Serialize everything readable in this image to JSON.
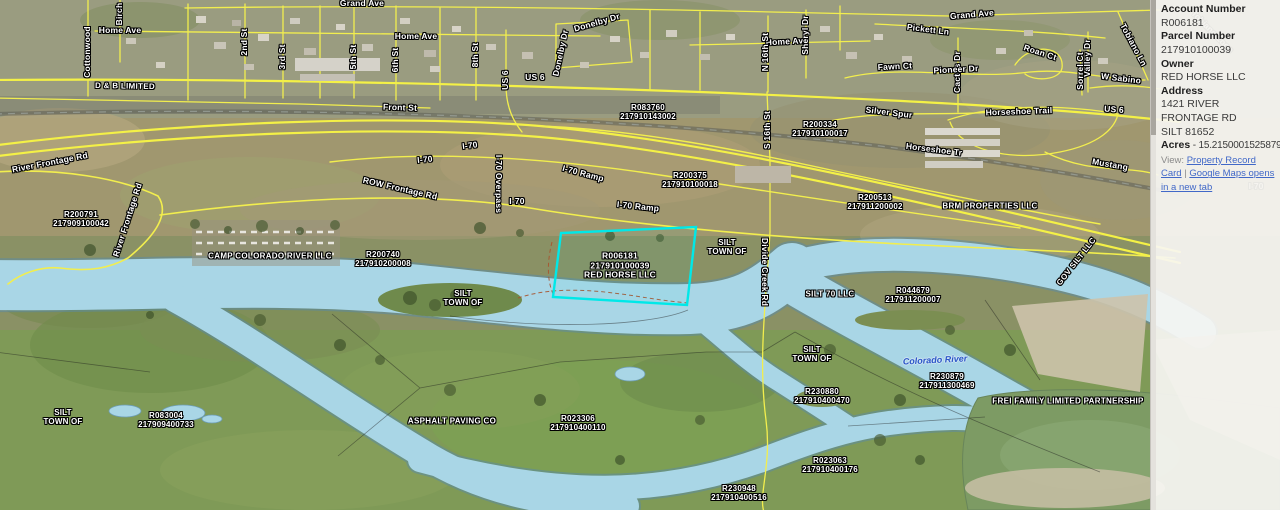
{
  "panel": {
    "fields": [
      {
        "label": "Account Number",
        "value": "R006181"
      },
      {
        "label": "Parcel Number",
        "value": "217910100039"
      },
      {
        "label": "Owner",
        "value": "RED HORSE LLC"
      },
      {
        "label": "Address",
        "value": "1421 RIVER FRONTAGE RD\nSILT 81652"
      }
    ],
    "acres": {
      "label": "Acres",
      "value": " - 15.2150001525879"
    },
    "view": {
      "label": "View: ",
      "separator": " | ",
      "links": [
        "Property Record Card",
        "Google Maps opens in a new tab"
      ]
    }
  },
  "map": {
    "selected_parcel": {
      "id": "R006181",
      "outline_color": "#00e8e8"
    },
    "colors": {
      "road": "#f2ee4e",
      "water": "#a9d6e6",
      "selection": "#00e8e8",
      "river_label": "#2b55c8"
    },
    "labels": [
      {
        "t": "Grand Ave",
        "x": 362,
        "y": 4,
        "r": 0,
        "k": "st"
      },
      {
        "t": "Grand Ave",
        "x": 972,
        "y": 15,
        "r": -5,
        "k": "st"
      },
      {
        "t": "Home Ave",
        "x": 120,
        "y": 31,
        "r": 0,
        "k": "st"
      },
      {
        "t": "Cottonwood",
        "x": 88,
        "y": 52,
        "r": -90,
        "k": "st"
      },
      {
        "t": "Birch",
        "x": 120,
        "y": 14,
        "r": -90,
        "k": "st"
      },
      {
        "t": "2nd St",
        "x": 245,
        "y": 42,
        "r": -90,
        "k": "st"
      },
      {
        "t": "3rd St",
        "x": 283,
        "y": 57,
        "r": -90,
        "k": "st"
      },
      {
        "t": "5th St",
        "x": 354,
        "y": 57,
        "r": -90,
        "k": "st"
      },
      {
        "t": "6th St",
        "x": 396,
        "y": 60,
        "r": -90,
        "k": "st"
      },
      {
        "t": "Home Ave",
        "x": 416,
        "y": 37,
        "r": 0,
        "k": "st"
      },
      {
        "t": "8th St",
        "x": 476,
        "y": 55,
        "r": -90,
        "k": "st"
      },
      {
        "t": "US 6",
        "x": 506,
        "y": 80,
        "r": -90,
        "k": "st"
      },
      {
        "t": "US 6",
        "x": 535,
        "y": 78,
        "r": 0,
        "k": "st"
      },
      {
        "t": "Donelby Dr",
        "x": 597,
        "y": 23,
        "r": -16,
        "k": "st"
      },
      {
        "t": "Donelby Dr",
        "x": 561,
        "y": 53,
        "r": -78,
        "k": "st"
      },
      {
        "t": "Home Ave",
        "x": 787,
        "y": 42,
        "r": -3,
        "k": "st"
      },
      {
        "t": "N 16th St",
        "x": 766,
        "y": 52,
        "r": -90,
        "k": "st"
      },
      {
        "t": "S 16th St",
        "x": 768,
        "y": 130,
        "r": -90,
        "k": "st"
      },
      {
        "t": "Sheryl Dr",
        "x": 806,
        "y": 35,
        "r": -90,
        "k": "st"
      },
      {
        "t": "Pickett Ln",
        "x": 928,
        "y": 30,
        "r": 7,
        "k": "st"
      },
      {
        "t": "Cactus Dr",
        "x": 958,
        "y": 72,
        "r": -90,
        "k": "st"
      },
      {
        "t": "Valley Dr",
        "x": 1088,
        "y": 58,
        "r": -90,
        "k": "st"
      },
      {
        "t": "Fawn Ct",
        "x": 895,
        "y": 67,
        "r": -3,
        "k": "st"
      },
      {
        "t": "Pioneer Dr",
        "x": 956,
        "y": 70,
        "r": -3,
        "k": "st"
      },
      {
        "t": "Roan Ct",
        "x": 1040,
        "y": 53,
        "r": 18,
        "k": "st"
      },
      {
        "t": "Sorrel Ct",
        "x": 1081,
        "y": 71,
        "r": -90,
        "k": "st"
      },
      {
        "t": "Tobiano Ln",
        "x": 1133,
        "y": 45,
        "r": 62,
        "k": "st"
      },
      {
        "t": "W Sabino",
        "x": 1121,
        "y": 79,
        "r": 7,
        "k": "st"
      },
      {
        "t": "D & B LIMITED",
        "x": 125,
        "y": 87,
        "r": 1,
        "k": "own"
      },
      {
        "t": "Front St",
        "x": 400,
        "y": 108,
        "r": 2,
        "k": "st"
      },
      {
        "t": "Silver Spur",
        "x": 889,
        "y": 113,
        "r": 7,
        "k": "st"
      },
      {
        "t": "Horseshoe Trail",
        "x": 1019,
        "y": 112,
        "r": -2,
        "k": "st"
      },
      {
        "t": "US 6",
        "x": 1114,
        "y": 110,
        "r": 4,
        "k": "st"
      },
      {
        "t": "Horseshoe Tr",
        "x": 934,
        "y": 150,
        "r": 7,
        "k": "st"
      },
      {
        "t": "Mustang",
        "x": 1110,
        "y": 165,
        "r": 10,
        "k": "st"
      },
      {
        "t": "River Frontage Rd",
        "x": 50,
        "y": 163,
        "r": -11,
        "k": "st"
      },
      {
        "t": "River Frontage Rd",
        "x": 128,
        "y": 220,
        "r": -72,
        "k": "st"
      },
      {
        "t": "I-70",
        "x": 425,
        "y": 160,
        "r": -6,
        "k": "st"
      },
      {
        "t": "I-70",
        "x": 470,
        "y": 146,
        "r": -7,
        "k": "st"
      },
      {
        "t": "I-70 Overpass",
        "x": 498,
        "y": 184,
        "r": 90,
        "k": "st"
      },
      {
        "t": "I-70",
        "x": 517,
        "y": 202,
        "r": 0,
        "k": "st"
      },
      {
        "t": "I-70 Ramp",
        "x": 583,
        "y": 174,
        "r": 15,
        "k": "st"
      },
      {
        "t": "I-70 Ramp",
        "x": 638,
        "y": 207,
        "r": 6,
        "k": "st"
      },
      {
        "t": "ROW Frontage Rd",
        "x": 400,
        "y": 189,
        "r": 13,
        "k": "st"
      },
      {
        "t": "Divide Creek Rd",
        "x": 764,
        "y": 272,
        "r": 90,
        "k": "st"
      },
      {
        "t": [
          "R083760",
          "217910143002"
        ],
        "x": 648,
        "y": 113,
        "r": 0,
        "k": "pid"
      },
      {
        "t": [
          "R200334",
          "217910100017"
        ],
        "x": 820,
        "y": 130,
        "r": 0,
        "k": "pid"
      },
      {
        "t": [
          "R200375",
          "217910100018"
        ],
        "x": 690,
        "y": 181,
        "r": 0,
        "k": "pid"
      },
      {
        "t": [
          "R200513",
          "217911200002"
        ],
        "x": 875,
        "y": 203,
        "r": 0,
        "k": "pid"
      },
      {
        "t": [
          "R200791",
          "217909100042"
        ],
        "x": 81,
        "y": 220,
        "r": 0,
        "k": "pid"
      },
      {
        "t": [
          "R200740",
          "217910200008"
        ],
        "x": 383,
        "y": 260,
        "r": 0,
        "k": "pid"
      },
      {
        "t": [
          "R006181",
          "217910100039",
          "RED HORSE LLC"
        ],
        "x": 620,
        "y": 266,
        "r": 0,
        "k": "sel"
      },
      {
        "t": [
          "R044679",
          "217911200007"
        ],
        "x": 913,
        "y": 296,
        "r": 0,
        "k": "pid"
      },
      {
        "t": [
          "R230879",
          "217911300469"
        ],
        "x": 947,
        "y": 382,
        "r": 0,
        "k": "pid"
      },
      {
        "t": [
          "R230880",
          "217910400470"
        ],
        "x": 822,
        "y": 397,
        "r": 0,
        "k": "pid"
      },
      {
        "t": [
          "R083004",
          "217909400733"
        ],
        "x": 166,
        "y": 421,
        "r": 0,
        "k": "pid"
      },
      {
        "t": [
          "R023306",
          "217910400110"
        ],
        "x": 578,
        "y": 424,
        "r": 0,
        "k": "pid"
      },
      {
        "t": [
          "R023063",
          "217910400176"
        ],
        "x": 830,
        "y": 466,
        "r": 0,
        "k": "pid"
      },
      {
        "t": [
          "R230948",
          "217910400516"
        ],
        "x": 739,
        "y": 494,
        "r": 0,
        "k": "pid"
      },
      {
        "t": "BRM PROPERTIES LLC",
        "x": 990,
        "y": 207,
        "r": 0,
        "k": "own"
      },
      {
        "t": "CAMP COLORADO RIVER LLC",
        "x": 270,
        "y": 257,
        "r": 0,
        "k": "own"
      },
      {
        "t": "SILT 70 LLC",
        "x": 830,
        "y": 295,
        "r": 0,
        "k": "own"
      },
      {
        "t": "GOV SILT LLC",
        "x": 1077,
        "y": 262,
        "r": -52,
        "k": "own"
      },
      {
        "t": "FREI FAMILY LIMITED PARTNERSHIP",
        "x": 1068,
        "y": 402,
        "r": 0,
        "k": "own"
      },
      {
        "t": "ASPHALT PAVING CO",
        "x": 452,
        "y": 422,
        "r": 0,
        "k": "own"
      },
      {
        "t": [
          "SILT",
          "TOWN OF"
        ],
        "x": 727,
        "y": 248,
        "r": 0,
        "k": "muni"
      },
      {
        "t": [
          "SILT",
          "TOWN OF"
        ],
        "x": 463,
        "y": 299,
        "r": 0,
        "k": "muni"
      },
      {
        "t": [
          "SILT",
          "TOWN OF"
        ],
        "x": 812,
        "y": 355,
        "r": 0,
        "k": "muni"
      },
      {
        "t": [
          "SILT",
          "TOWN OF"
        ],
        "x": 63,
        "y": 418,
        "r": 0,
        "k": "muni"
      },
      {
        "t": "Colorado River",
        "x": 935,
        "y": 360,
        "r": -3,
        "k": "wat"
      },
      {
        "t": "I-70",
        "x": 1256,
        "y": 187,
        "r": 0,
        "k": "gst"
      },
      {
        "t": "Tobiano Loop",
        "x": 1212,
        "y": 32,
        "r": 45,
        "k": "gst"
      }
    ]
  }
}
